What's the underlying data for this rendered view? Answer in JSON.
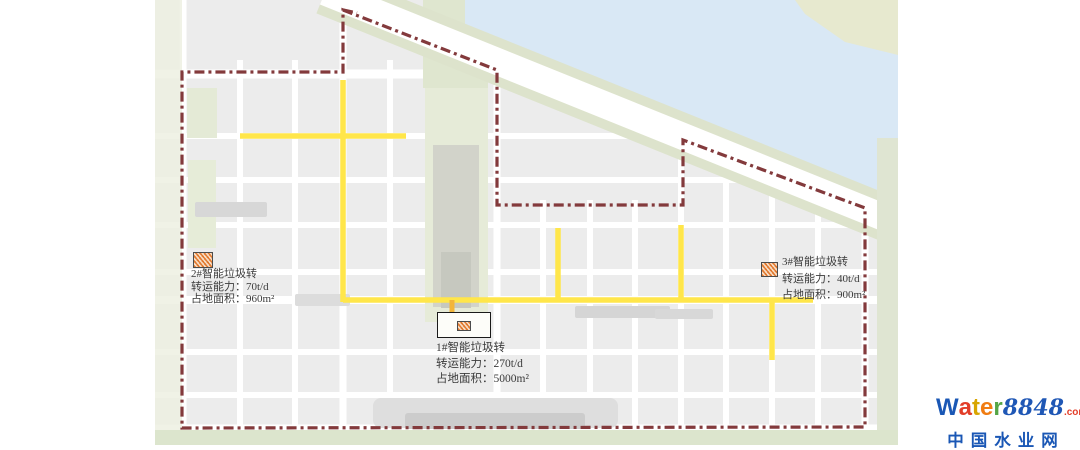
{
  "map": {
    "stations": [
      {
        "title": "1#智能垃圾转",
        "capacity": "转运能力：270t/d",
        "area": "占地面积：5000m²"
      },
      {
        "title": "2#智能垃圾转",
        "capacity": "转运能力：70t/d",
        "area": "占地面积：960m²"
      },
      {
        "title": "3#智能垃圾转",
        "capacity": "转运能力：40t/d",
        "area": "占地面积：900m²"
      }
    ]
  },
  "watermark": {
    "letters": [
      {
        "ch": "W",
        "color": "#1a57b5"
      },
      {
        "ch": "a",
        "color": "#e23d28"
      },
      {
        "ch": "t",
        "color": "#d8a500"
      },
      {
        "ch": "e",
        "color": "#f07c12"
      },
      {
        "ch": "r",
        "color": "#55a546"
      }
    ],
    "number": "8848",
    "tld": ".com",
    "subtitle": "中国水业网",
    "number_color": "#1f57b5",
    "tld_color": "#e23d28",
    "subtitle_color": "#1a57b5"
  },
  "colors": {
    "boundary": "#833a3c",
    "road": "#ffe64a",
    "road_stub": "#f2b53a",
    "river": "#d9e8f5",
    "block": "#ececec",
    "green": "#e3e9d3"
  }
}
